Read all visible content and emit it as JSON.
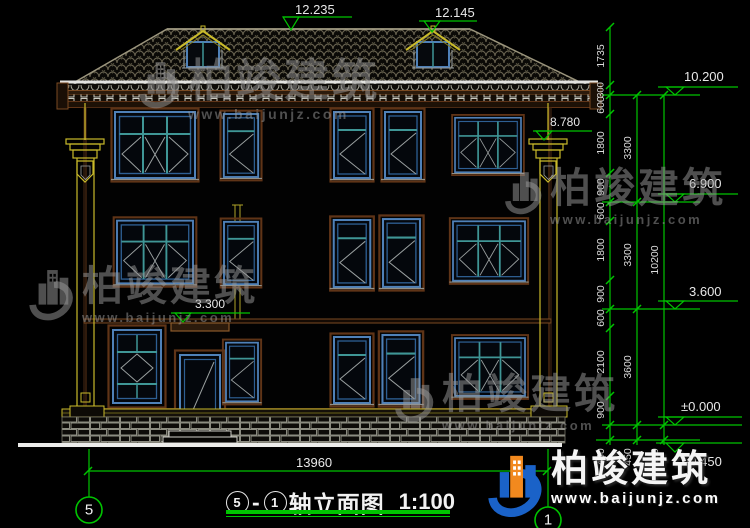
{
  "title": {
    "body": "轴立面图",
    "scale": "1:100"
  },
  "axes": {
    "left": "5",
    "right": "1"
  },
  "watermark": {
    "brand": "柏竣建筑",
    "url": "www.baijunjz.com"
  },
  "dimensions": {
    "overall_width": "13960",
    "chain_inner": [
      "1735",
      "300",
      "600",
      "1800",
      "900",
      "600",
      "1800",
      "900",
      "600",
      "2100",
      "900",
      "450"
    ],
    "chain_floor": [
      "3300",
      "3300",
      "3600",
      "450"
    ],
    "chain_total": [
      "10200",
      "450"
    ]
  },
  "elevations": {
    "ridge": "12.235",
    "dormer_ridge": "12.145",
    "eave_top": "10.200",
    "column_top": "8.780",
    "floor3": "6.900",
    "floor2": "3.600",
    "canopy": "3.300",
    "ground": "±0.000",
    "below_ground": "-0.450"
  }
}
